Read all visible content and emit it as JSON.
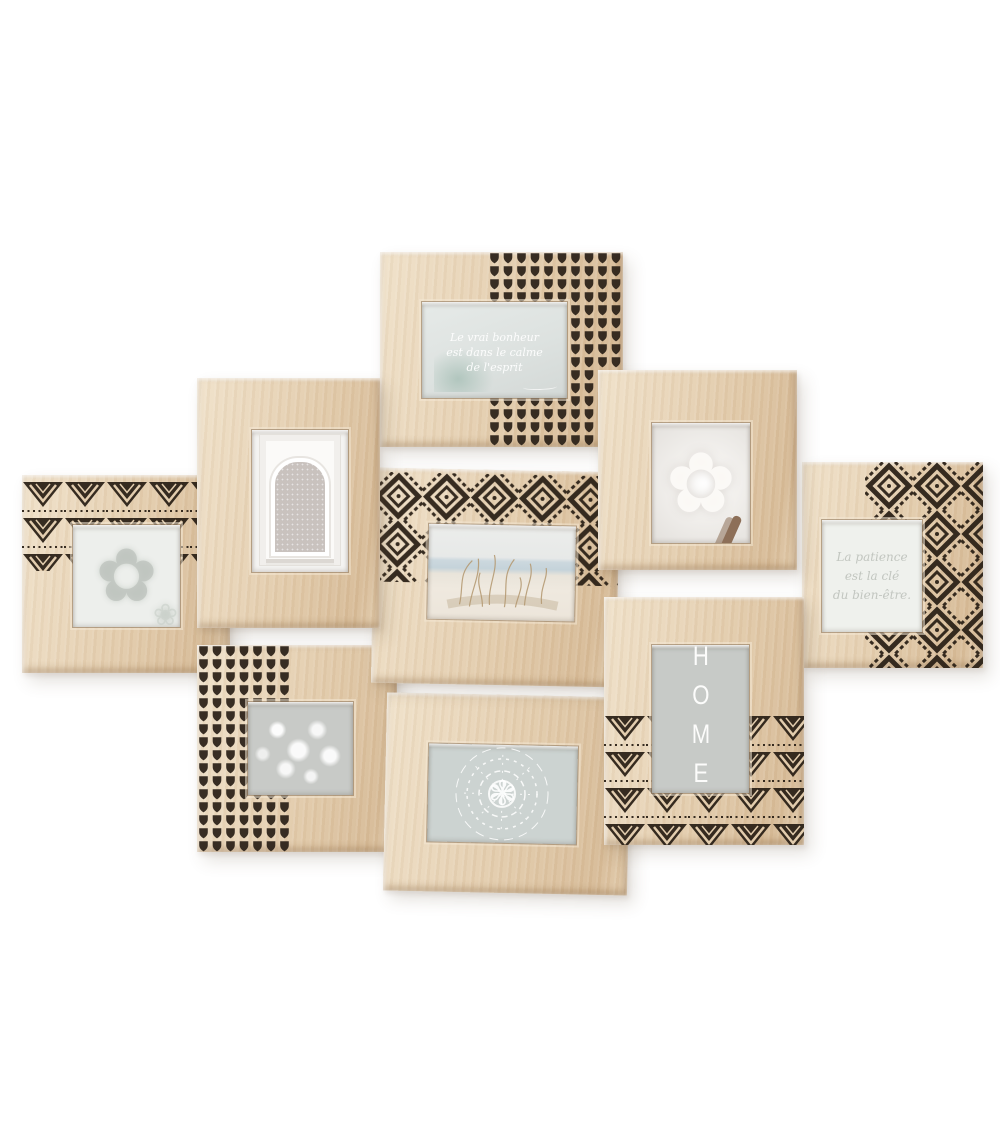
{
  "product": {
    "name": "wooden multi-photo collage frame",
    "frame_count": 9,
    "background": "#ffffff",
    "colors": {
      "wood_light": "#f0e2ca",
      "wood_mid": "#e5cfb1",
      "wood_deep": "#d7bb97",
      "pattern_ink": "#2b2117",
      "photo_grey": "#c9ccc9"
    },
    "frames": [
      {
        "id": "left-mandala",
        "pattern": "triangle-zigzag",
        "photo": "faint-mandala-print"
      },
      {
        "id": "moroccan-arch",
        "pattern": "plain",
        "photo": "moroccan-arch-doorway"
      },
      {
        "id": "quote",
        "pattern": "heart-dots",
        "photo": "quote-print",
        "text": {
          "line1": "Le vrai bonheur",
          "line2": "est dans le calme",
          "line3": "de l'esprit"
        }
      },
      {
        "id": "white-flower",
        "pattern": "plain",
        "photo": "white-flower"
      },
      {
        "id": "patience",
        "pattern": "chevron-fan",
        "photo": "quote-print",
        "text": {
          "line1": "La patience",
          "line2": "est la clé",
          "line3": "du bien-être."
        }
      },
      {
        "id": "beach",
        "pattern": "chevron-fan",
        "photo": "dune-grass-seascape"
      },
      {
        "id": "babys-breath",
        "pattern": "heart-dots",
        "photo": "babys-breath-flowers"
      },
      {
        "id": "bottom-mandala",
        "pattern": "plain",
        "photo": "ornate-mandala-print"
      },
      {
        "id": "home",
        "pattern": "triangle-zigzag",
        "photo": "home-typography",
        "text": {
          "word": "HOME"
        }
      }
    ]
  }
}
